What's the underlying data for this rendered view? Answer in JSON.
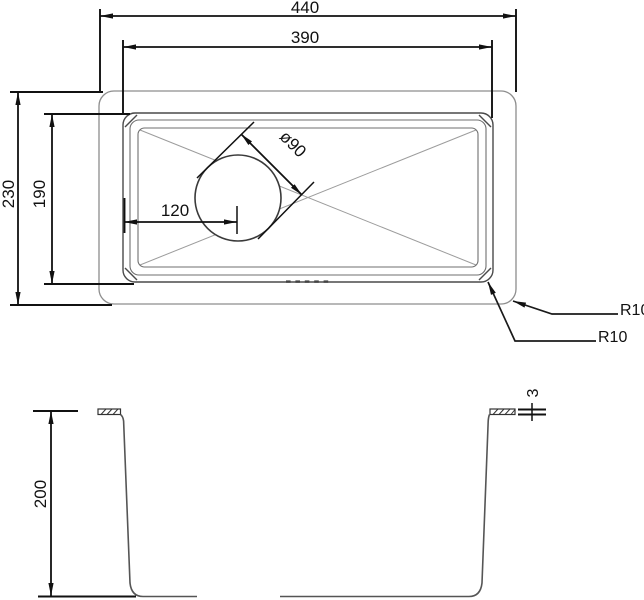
{
  "drawing": {
    "type": "sink technical drawing, top view and cross-section",
    "top_view": {
      "dim_outer_width": "440",
      "dim_bowl_width": "390",
      "dim_outer_depth": "230",
      "dim_bowl_depth": "190",
      "dim_drain_offset": "120",
      "dim_drain_diameter": "ø90",
      "radius_outer_corner": "R10",
      "radius_bowl_corner": "R10"
    },
    "section_view": {
      "dim_depth": "200",
      "dim_rim_thickness": "3"
    },
    "colors": {
      "line_dark": "#111111",
      "edge_gray": "#8d8d8d",
      "background": "#ffffff"
    }
  }
}
